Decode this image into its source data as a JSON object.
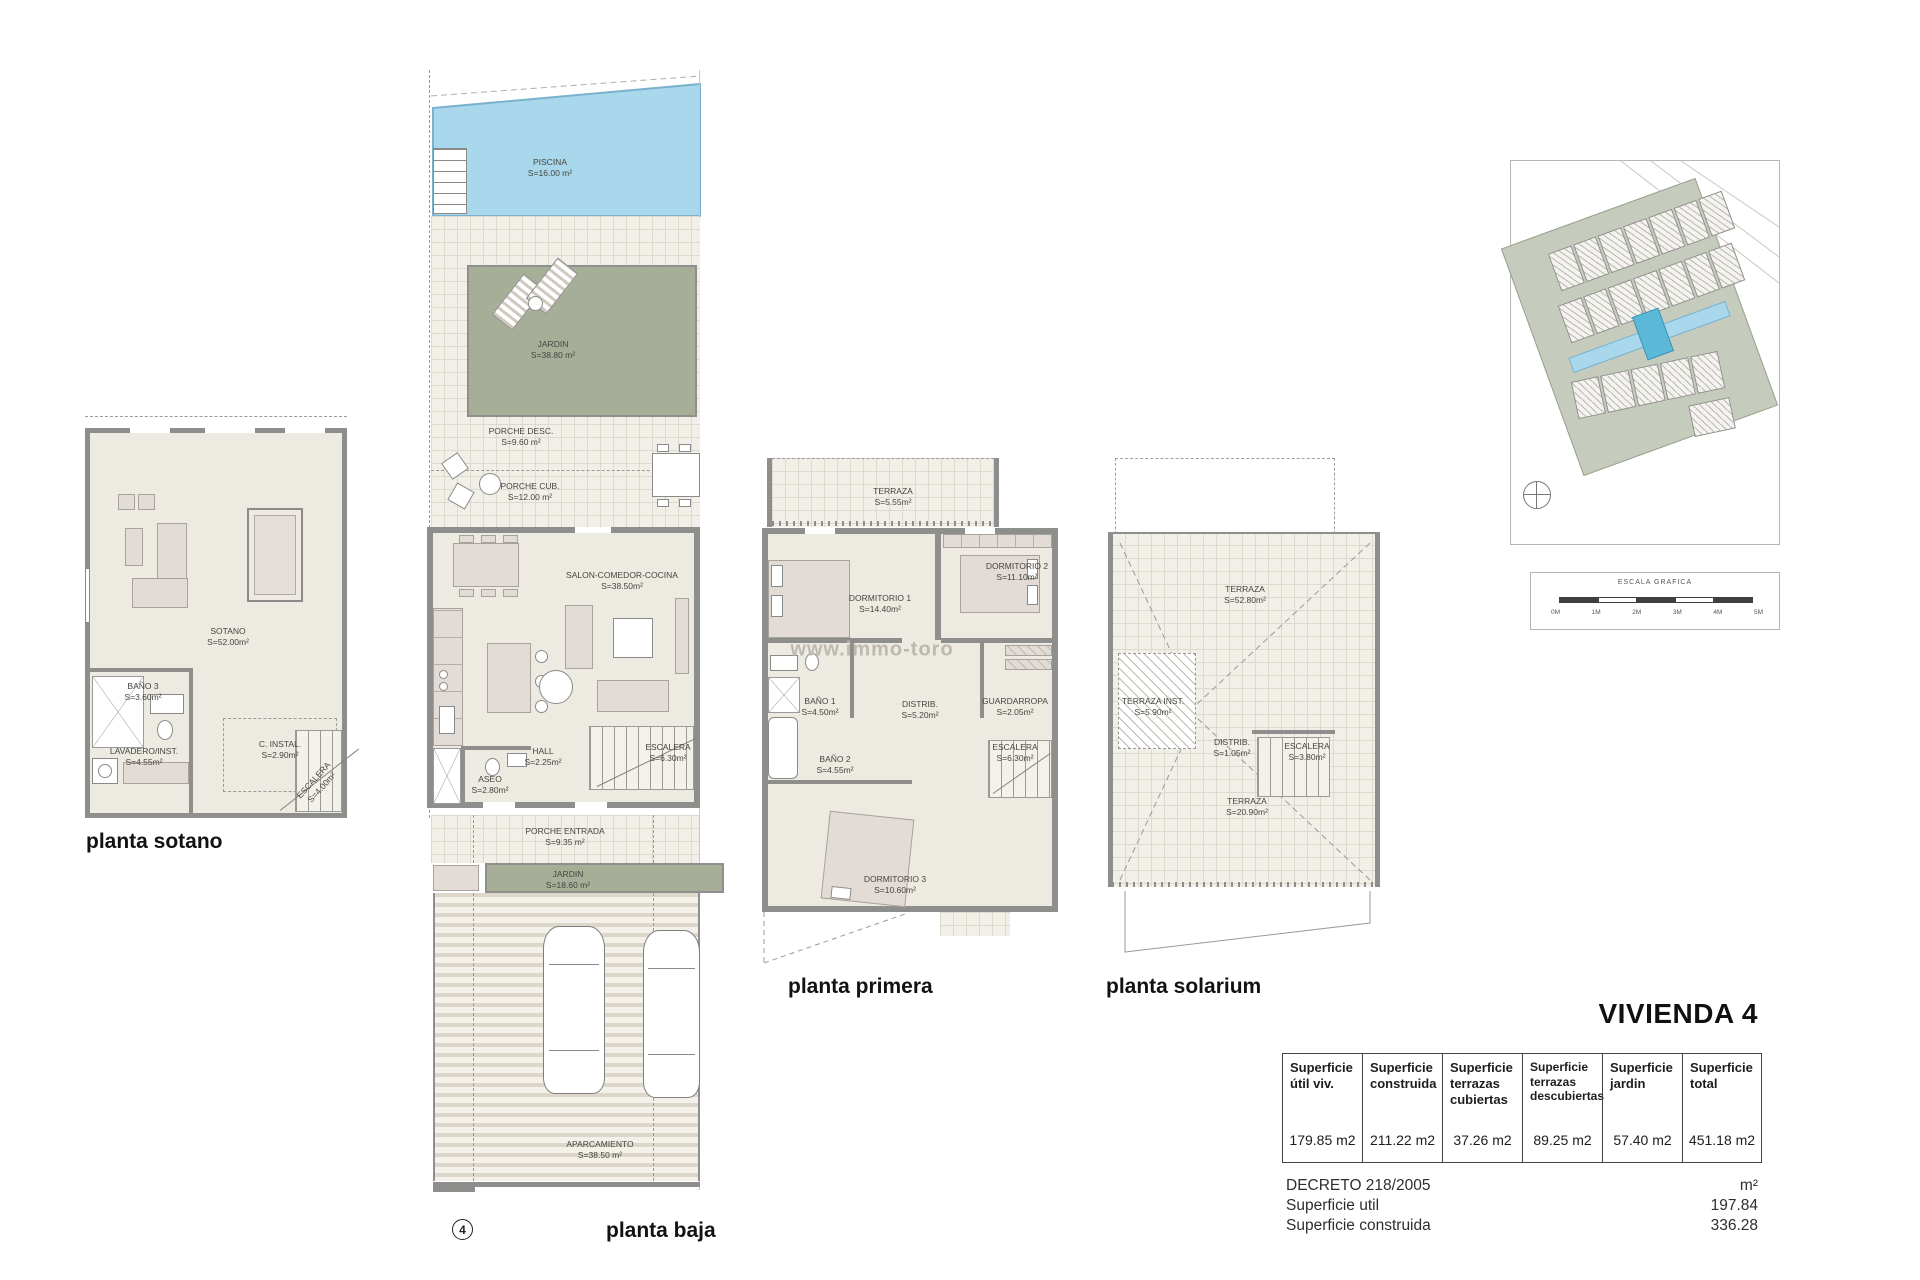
{
  "watermark": "www.immo-toro",
  "plans": {
    "sotano": {
      "title": "planta sotano",
      "rooms": [
        {
          "name": "SOTANO",
          "area": "S=52.00m²"
        },
        {
          "name": "BAÑO 3",
          "area": "S=3.60m²"
        },
        {
          "name": "LAVADERO/INST.",
          "area": "S=4.55m²"
        },
        {
          "name": "C. INSTAL.",
          "area": "S=2.90m²"
        },
        {
          "name": "ESCALERA",
          "area": "S=4.00m²"
        }
      ]
    },
    "baja": {
      "title": "planta baja",
      "badge": "4",
      "rooms": [
        {
          "name": "PISCINA",
          "area": "S=16.00 m²"
        },
        {
          "name": "JARDIN",
          "area": "S=38.80 m²"
        },
        {
          "name": "PORCHE DESC.",
          "area": "S=9.60 m²"
        },
        {
          "name": "PORCHE CUB.",
          "area": "S=12.00 m²"
        },
        {
          "name": "SALON-COMEDOR-COCINA",
          "area": "S=38.50m²"
        },
        {
          "name": "HALL",
          "area": "S=2.25m²"
        },
        {
          "name": "ASEO",
          "area": "S=2.80m²"
        },
        {
          "name": "ESCALERA",
          "area": "S=6.30m²"
        },
        {
          "name": "PORCHE ENTRADA",
          "area": "S=9.35 m²"
        },
        {
          "name": "JARDIN",
          "area": "S=18.60 m²"
        },
        {
          "name": "APARCAMIENTO",
          "area": "S=38.50 m²"
        }
      ]
    },
    "primera": {
      "title": "planta primera",
      "rooms": [
        {
          "name": "TERRAZA",
          "area": "S=5.55m²"
        },
        {
          "name": "DORMITORIO 1",
          "area": "S=14.40m²"
        },
        {
          "name": "DORMITORIO 2",
          "area": "S=11.10m²"
        },
        {
          "name": "BAÑO 1",
          "area": "S=4.50m²"
        },
        {
          "name": "DISTRIB.",
          "area": "S=5.20m²"
        },
        {
          "name": "GUARDARROPA",
          "area": "S=2.05m²"
        },
        {
          "name": "BAÑO 2",
          "area": "S=4.55m²"
        },
        {
          "name": "ESCALERA",
          "area": "S=6.30m²"
        },
        {
          "name": "DORMITORIO 3",
          "area": "S=10.60m²"
        }
      ]
    },
    "solarium": {
      "title": "planta solarium",
      "rooms": [
        {
          "name": "TERRAZA",
          "area": "S=52.80m²"
        },
        {
          "name": "TERRAZA INST.",
          "area": "S=5.90m²"
        },
        {
          "name": "DISTRIB.",
          "area": "S=1.05m²"
        },
        {
          "name": "ESCALERA",
          "area": "S=3.80m²"
        },
        {
          "name": "TERRAZA",
          "area": "S=20.90m²"
        }
      ]
    }
  },
  "siteplan": {
    "scale_title": "ESCALA GRAFICA",
    "ticks": [
      "0M",
      "1M",
      "2M",
      "3M",
      "4M",
      "5M"
    ]
  },
  "summary": {
    "title": "VIVIENDA 4",
    "columns": [
      {
        "header": "Superficie útil viv.",
        "value": "179.85 m2"
      },
      {
        "header": "Superficie construida",
        "value": "211.22 m2"
      },
      {
        "header": "Superficie terrazas cubiertas",
        "value": "37.26 m2"
      },
      {
        "header": "Superficie terrazas descubiertas",
        "value": "89.25 m2"
      },
      {
        "header": "Superficie jardin",
        "value": "57.40 m2"
      },
      {
        "header": "Superficie total",
        "value": "451.18 m2"
      }
    ],
    "decreto": {
      "title": "DECRETO 218/2005",
      "unit": "m²",
      "rows": [
        {
          "label": "Superficie util",
          "value": "197.84"
        },
        {
          "label": "Superficie construida",
          "value": "336.28"
        }
      ]
    }
  }
}
